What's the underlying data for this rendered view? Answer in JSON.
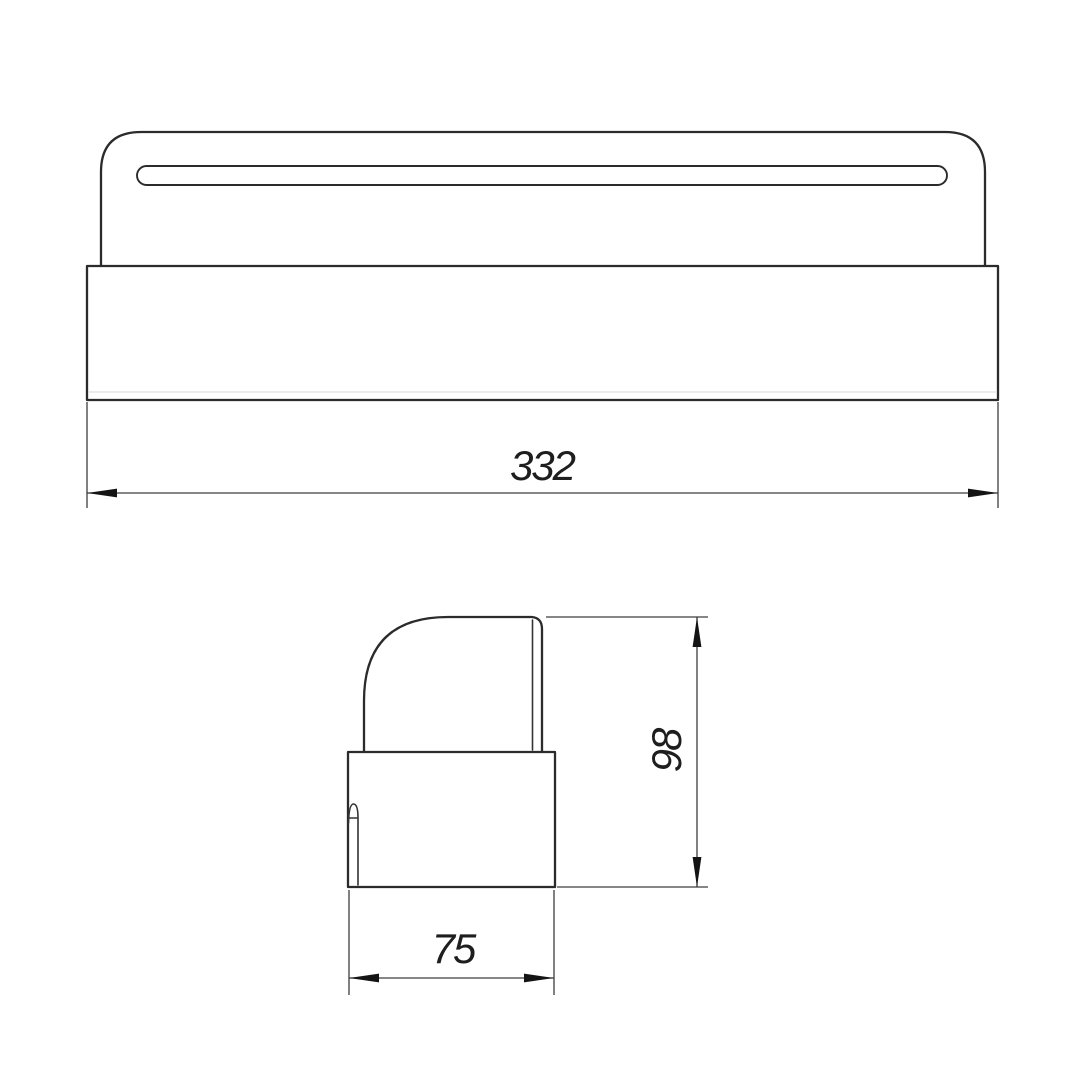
{
  "drawing": {
    "background": "#ffffff",
    "outline_color": "#2b2b2b",
    "edge_color": "#333333",
    "faint_line_color": "#d9d9d9",
    "dim_color": "#3d3d3d",
    "arrow_color": "#141414",
    "text_color": "#1e1e1e",
    "front_view": {
      "width_dimension": "332"
    },
    "side_view": {
      "height_dimension": "98",
      "depth_dimension": "75"
    }
  }
}
